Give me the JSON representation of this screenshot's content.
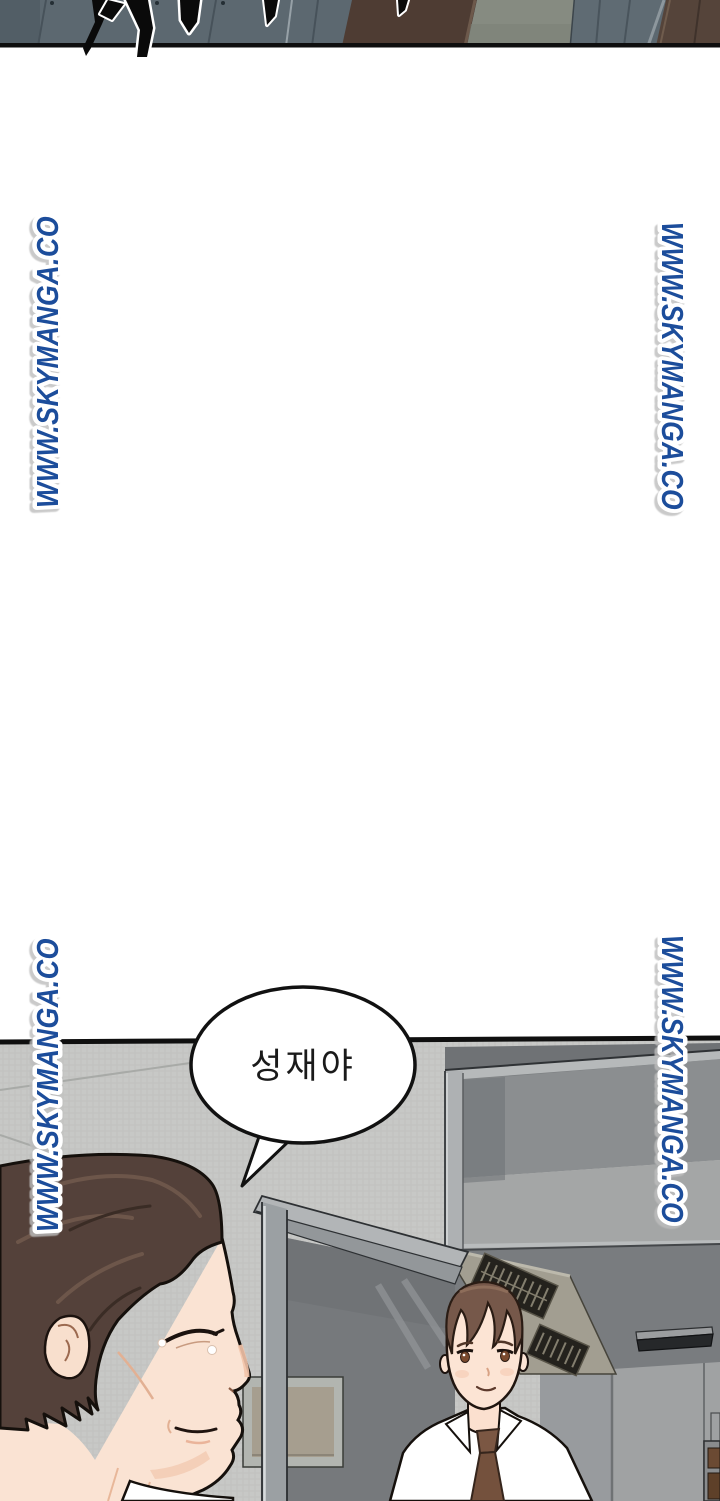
{
  "page": {
    "kind": "webtoon-comic-page",
    "width": 720,
    "height": 1501,
    "background": "#ffffff"
  },
  "watermark": {
    "text": "WWW.SKYMANGA.CO",
    "color": "#1d4d9b",
    "outline_color": "#ffffff",
    "instances": [
      {
        "position": "upper-left",
        "reading": "bottom-to-top"
      },
      {
        "position": "upper-right",
        "reading": "top-to-bottom"
      },
      {
        "position": "lower-left",
        "reading": "bottom-to-top"
      },
      {
        "position": "lower-right",
        "reading": "top-to-bottom"
      }
    ]
  },
  "top_panel": {
    "border_color": "#0e0e0e",
    "wall_color": "#5c6870",
    "accent_brown": "#4e3c33"
  },
  "main_panel": {
    "border_color": "#0f0f0f",
    "wall_color": "#c7c8c6",
    "speech_bubble": {
      "text": "성재야",
      "fill": "#ffffff",
      "border": "#111111",
      "text_color": "#1a1a1a"
    }
  }
}
